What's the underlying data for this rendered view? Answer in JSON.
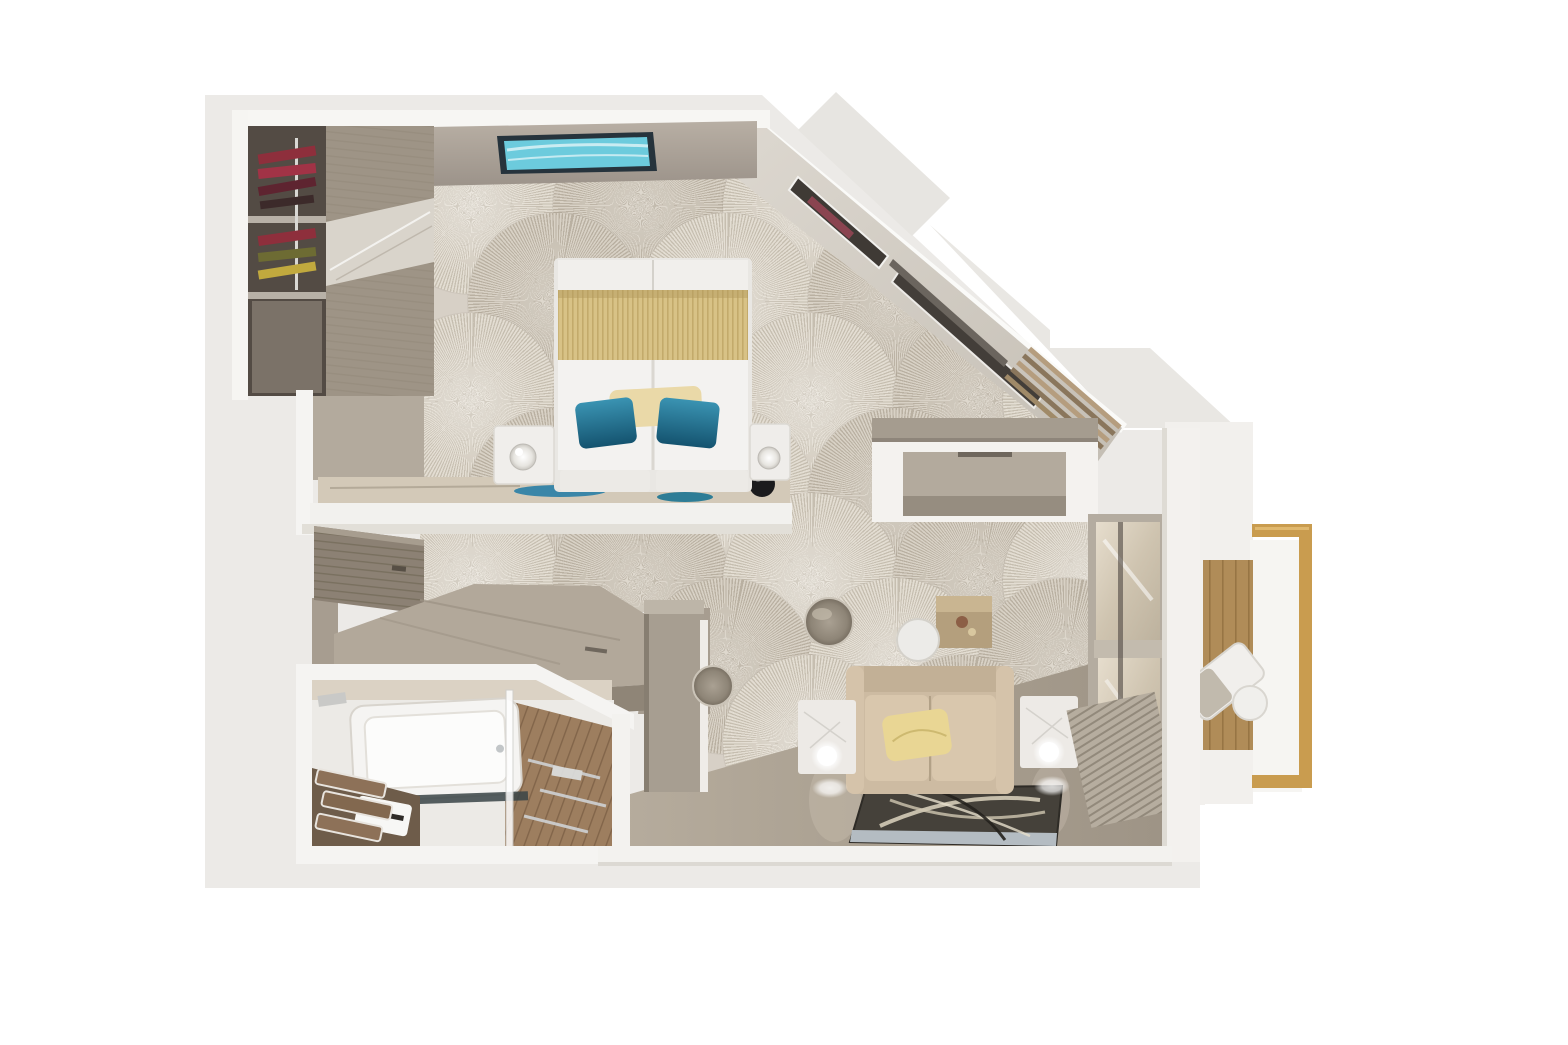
{
  "scene": {
    "type": "3d-floorplan-top-down-render",
    "rooms": [
      {
        "name": "bedroom",
        "items": [
          "double-bed",
          "gold-bed-runner",
          "teal-accent-pillow-left",
          "teal-accent-pillow-right",
          "cream-lumbar-pillow",
          "nightstand-left",
          "nightstand-right",
          "glass-sphere-lamp-left",
          "glass-sphere-lamp-right",
          "black-sphere-decor",
          "foot-of-bed-console",
          "console-blue-art",
          "wall-mounted-tv",
          "sunburst-pattern-carpet",
          "angled-window-wall",
          "window-slot-1",
          "window-slot-2",
          "wood-slat-blind",
          "open-wardrobe",
          "hanging-clothes",
          "wardrobe-shelf"
        ]
      },
      {
        "name": "entry-hall",
        "items": [
          "sliding-wood-door",
          "angled-vanity-desk",
          "round-stool",
          "tall-cabinet"
        ]
      },
      {
        "name": "bathroom",
        "items": [
          "bathtub",
          "glass-shower-partition",
          "wood-floor",
          "vanity-counter",
          "sink",
          "towel-stack",
          "towel-bar",
          "chrome-fixtures"
        ]
      },
      {
        "name": "living-area",
        "items": [
          "loveseat-sofa",
          "yellow-throw-pillow",
          "marble-cube-table-left",
          "marble-cube-table-right",
          "sphere-lamp-left",
          "sphere-lamp-right",
          "leaf-pattern-rug",
          "wood-cube-table",
          "round-white-table",
          "metal-pouf",
          "picture-window",
          "radiator-vent",
          "desk-console-wall"
        ]
      },
      {
        "name": "balcony",
        "items": [
          "wood-deck",
          "gold-railing",
          "lounge-chair",
          "round-side-table"
        ]
      }
    ],
    "colors": {
      "page_background": "#ffffff",
      "exterior_silhouette": "#eceae7",
      "wall_white": "#f5f4f1",
      "wall_face_taupe": "#aaa196",
      "carpet_base": "#d7d0c6",
      "carpet_spoke_light": "#e3ddd2",
      "carpet_spoke_dark": "#b9b0a1",
      "hard_floor_greige": "#aca293",
      "bathroom_wood": "#9d7e5f",
      "balcony_deck": "#b08c58",
      "gold_railing": "#c99c4f",
      "bed_white": "#f2f1ee",
      "bed_gold": "#d8c286",
      "pillow_teal": "#2a7e9e",
      "pillow_cream": "#ead9a8",
      "sofa_beige": "#d2c0a6",
      "pillow_yellow": "#e9d694",
      "rug_dark": "#45413a",
      "rug_stripe_blue": "#b4bcc2",
      "marble_white": "#edeae6",
      "tv_screen_cyan": "#6ccbdd",
      "wardrobe_dark": "#534b44",
      "clothes_maroon": "#8e2f3c",
      "clothes_yellow": "#c1a93e",
      "clothes_olive": "#6d6b33"
    }
  }
}
